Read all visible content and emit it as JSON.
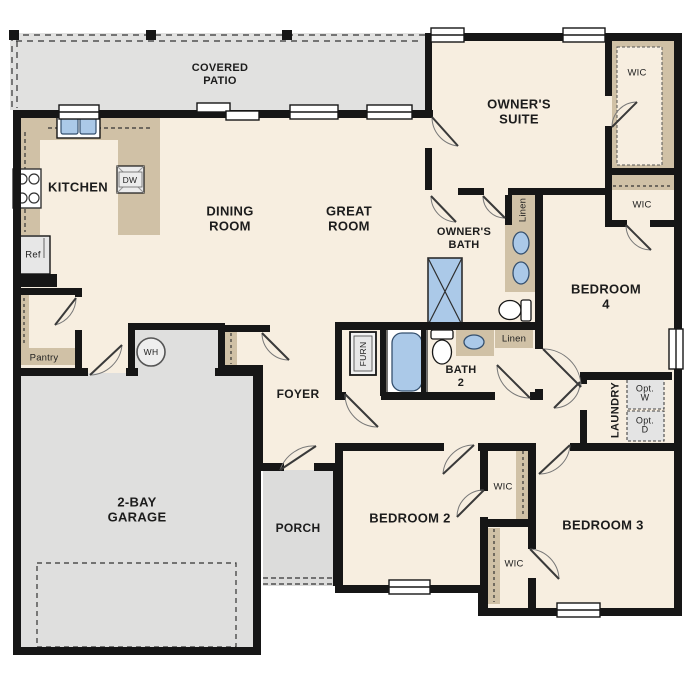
{
  "labels": {
    "covered_patio": "COVERED\nPATIO",
    "kitchen": "KITCHEN",
    "dining_room": "DINING\nROOM",
    "great_room": "GREAT\nROOM",
    "owners_suite": "OWNER'S\nSUITE",
    "owners_bath": "OWNER'S\nBATH",
    "bedroom2": "BEDROOM 2",
    "bedroom3": "BEDROOM 3",
    "bedroom4": "BEDROOM 4",
    "bath2": "BATH\n2",
    "foyer": "FOYER",
    "porch": "PORCH",
    "garage": "2-BAY\nGARAGE",
    "laundry": "LAUNDRY",
    "pantry": "Pantry",
    "wic_owner": "WIC",
    "wic_bed4": "WIC",
    "wic_bed2": "WIC",
    "wic_bed3": "WIC",
    "linen_owner": "Linen",
    "linen_bath2": "Linen",
    "furnace": "FURN",
    "opt_washer": "Opt.\nW",
    "opt_dryer": "Opt.\nD",
    "water_heater": "WH",
    "refrigerator": "Ref",
    "dishwasher": "DW"
  },
  "colors": {
    "wall": "#161616",
    "floor_cream": "#f7eee0",
    "patio_garage_gray": "#dfdfdf",
    "cabinet_tan": "#d0c1a6",
    "fixture_blue": "#abc9e8",
    "appliance_gray": "#e7e7e7"
  }
}
